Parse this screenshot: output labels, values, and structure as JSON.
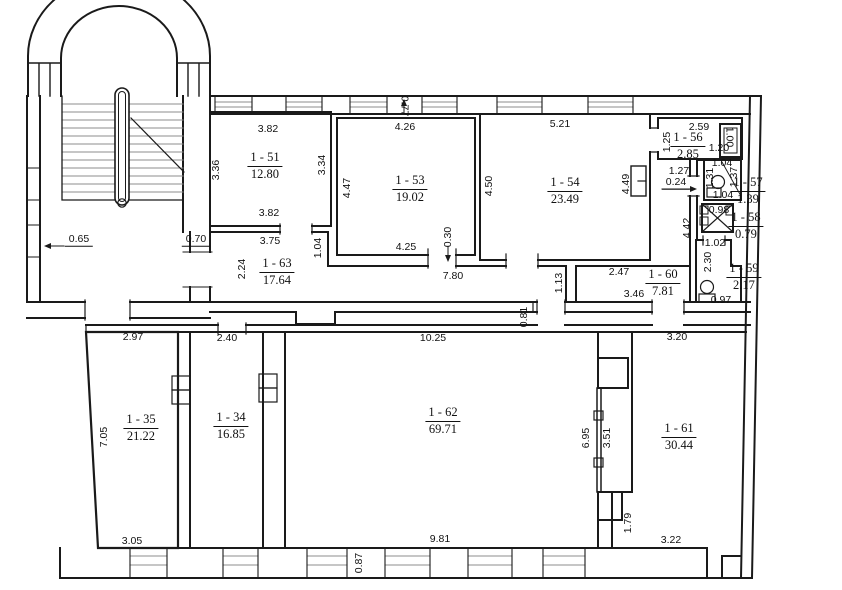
{
  "drawing": {
    "type": "architectural floor plan",
    "line_color": "#1a1a1a",
    "secondary_line_color": "#8c8c8c",
    "background": "#ffffff"
  },
  "rooms": [
    {
      "id": "1 - 51",
      "area": "12.80",
      "x": 265,
      "y": 166
    },
    {
      "id": "1 - 53",
      "area": "19.02",
      "x": 410,
      "y": 189
    },
    {
      "id": "1 - 54",
      "area": "23.49",
      "x": 565,
      "y": 191
    },
    {
      "id": "1 - 56",
      "area": "2.85",
      "x": 688,
      "y": 146
    },
    {
      "id": "1 - 57",
      "area": "1.39",
      "x": 748,
      "y": 191
    },
    {
      "id": "1 - 58",
      "area": "0.79",
      "x": 746,
      "y": 226
    },
    {
      "id": "1 - 59",
      "area": "2.17",
      "x": 744,
      "y": 277
    },
    {
      "id": "1 - 60",
      "area": "7.81",
      "x": 663,
      "y": 283
    },
    {
      "id": "1 - 63",
      "area": "17.64",
      "x": 277,
      "y": 272
    },
    {
      "id": "1 - 35",
      "area": "21.22",
      "x": 141,
      "y": 428
    },
    {
      "id": "1 - 34",
      "area": "16.85",
      "x": 231,
      "y": 426
    },
    {
      "id": "1 - 62",
      "area": "69.71",
      "x": 443,
      "y": 421
    },
    {
      "id": "1 - 61",
      "area": "30.44",
      "x": 679,
      "y": 437
    }
  ],
  "dims": [
    {
      "t": "0.65",
      "x": 79,
      "y": 240,
      "r": 0,
      "ul": true
    },
    {
      "t": "0.70",
      "x": 196,
      "y": 240,
      "r": 0,
      "ul": true
    },
    {
      "t": "3.82",
      "x": 268,
      "y": 129,
      "r": 0
    },
    {
      "t": "3.36",
      "x": 216,
      "y": 170,
      "r": -90
    },
    {
      "t": "3.34",
      "x": 322,
      "y": 165,
      "r": -90
    },
    {
      "t": "3.82",
      "x": 269,
      "y": 213,
      "r": 0
    },
    {
      "t": "3.75",
      "x": 270,
      "y": 241,
      "r": 0
    },
    {
      "t": "2.24",
      "x": 242,
      "y": 269,
      "r": -90
    },
    {
      "t": "1.04",
      "x": 318,
      "y": 248,
      "r": -90
    },
    {
      "t": "4.26",
      "x": 405,
      "y": 127,
      "r": 0
    },
    {
      "t": "0.77",
      "x": 404,
      "y": 106,
      "r": 90
    },
    {
      "t": "4.47",
      "x": 347,
      "y": 188,
      "r": -90
    },
    {
      "t": "4.25",
      "x": 406,
      "y": 247,
      "r": 0
    },
    {
      "t": "0.30",
      "x": 448,
      "y": 237,
      "r": -90
    },
    {
      "t": "7.80",
      "x": 453,
      "y": 276,
      "r": 0
    },
    {
      "t": "5.21",
      "x": 560,
      "y": 124,
      "r": 0
    },
    {
      "t": "4.50",
      "x": 489,
      "y": 186,
      "r": -90
    },
    {
      "t": "4.49",
      "x": 626,
      "y": 184,
      "r": -90
    },
    {
      "t": "1.13",
      "x": 559,
      "y": 283,
      "r": -90
    },
    {
      "t": "0.81",
      "x": 524,
      "y": 317,
      "r": -90
    },
    {
      "t": "2.47",
      "x": 619,
      "y": 272,
      "r": 0
    },
    {
      "t": "3.46",
      "x": 634,
      "y": 294,
      "r": 0
    },
    {
      "t": "2.59",
      "x": 699,
      "y": 127,
      "r": 0
    },
    {
      "t": "1.25",
      "x": 667,
      "y": 142,
      "r": -90
    },
    {
      "t": "1.00",
      "x": 729,
      "y": 137,
      "r": 90
    },
    {
      "t": "1.20",
      "x": 719,
      "y": 148,
      "r": 0
    },
    {
      "t": "1.04",
      "x": 722,
      "y": 163,
      "r": 0
    },
    {
      "t": "1.31",
      "x": 710,
      "y": 178,
      "r": -90
    },
    {
      "t": "1.37",
      "x": 734,
      "y": 177,
      "r": -90
    },
    {
      "t": "1.04",
      "x": 723,
      "y": 195,
      "r": 0
    },
    {
      "t": "1.27",
      "x": 679,
      "y": 171,
      "r": 0
    },
    {
      "t": "0.24",
      "x": 676,
      "y": 183,
      "r": 0,
      "ul": true
    },
    {
      "t": "4.42",
      "x": 687,
      "y": 228,
      "r": -90
    },
    {
      "t": "0.98",
      "x": 719,
      "y": 210,
      "r": 0
    },
    {
      "t": "1.02",
      "x": 715,
      "y": 243,
      "r": 0
    },
    {
      "t": "2.30",
      "x": 708,
      "y": 262,
      "r": -90
    },
    {
      "t": "0.97",
      "x": 721,
      "y": 300,
      "r": 0
    },
    {
      "t": "2.97",
      "x": 133,
      "y": 337,
      "r": 0
    },
    {
      "t": "2.40",
      "x": 227,
      "y": 338,
      "r": 0
    },
    {
      "t": "10.25",
      "x": 433,
      "y": 338,
      "r": 0
    },
    {
      "t": "3.20",
      "x": 677,
      "y": 337,
      "r": 0
    },
    {
      "t": "7.05",
      "x": 104,
      "y": 437,
      "r": -90
    },
    {
      "t": "6.95",
      "x": 586,
      "y": 438,
      "r": -90
    },
    {
      "t": "3.51",
      "x": 607,
      "y": 438,
      "r": -90
    },
    {
      "t": "1.79",
      "x": 628,
      "y": 523,
      "r": -90
    },
    {
      "t": "3.05",
      "x": 132,
      "y": 541,
      "r": 0
    },
    {
      "t": "9.81",
      "x": 440,
      "y": 539,
      "r": 0
    },
    {
      "t": "3.22",
      "x": 671,
      "y": 540,
      "r": 0
    },
    {
      "t": "0.87",
      "x": 359,
      "y": 563,
      "r": -90
    }
  ]
}
